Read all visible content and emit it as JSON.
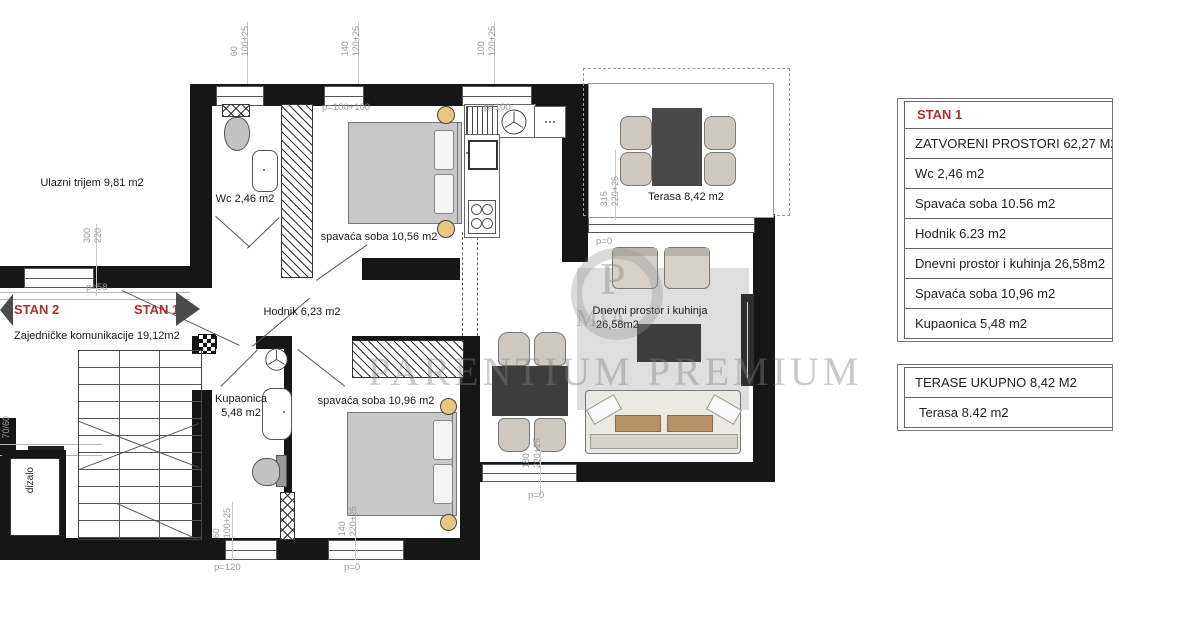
{
  "plan": {
    "labels": {
      "ulazni": "Ulazni trijem 9,81 m2",
      "wc": "Wc 2,46 m2",
      "soba1": "spavaća soba 10,56 m2",
      "terasa": "Terasa 8,42 m2",
      "hodnik": "Hodnik 6,23 m2",
      "zajednicke": "Zajedničke komunikacije 19,12m2",
      "kupaonica_1": "Kupaonica",
      "kupaonica_2": "5,48 m2",
      "soba2": "spavaća soba 10,96 m2",
      "dnevni_1": "Dnevni prostor i kuhinja",
      "dnevni_2": "26,58m2",
      "dizalo": "dizalo",
      "stan1": "STAN 1",
      "stan2": "STAN 2"
    },
    "dims": {
      "top1a": "60",
      "top1b": "100+25",
      "top2a": "140",
      "top2b": "120+25",
      "top3a": "100",
      "top3b": "120+25",
      "ter_a": "315",
      "ter_b": "220+25",
      "left_a": "300",
      "left_b": "220",
      "left_p": "p=58",
      "lift": "70/60",
      "bot1a": "60",
      "bot1b": "100+25",
      "bot1p": "p=120",
      "bot2a": "140",
      "bot2b": "220+25",
      "bot2p": "p=0",
      "liv_a": "180",
      "liv_b": "220+25",
      "liv_p": "p=0",
      "kit_p1": "p=100+100",
      "kit_p2": "p=100",
      "ter_p": "p=0"
    },
    "watermark": {
      "text": "PARENTIUM PREMIUM",
      "logo": "P",
      "logo_sub": "MIA"
    }
  },
  "tables": {
    "stan1": {
      "title": "STAN 1",
      "rows": [
        "ZATVORENI PROSTORI 62,27 M2",
        "Wc 2,46 m2",
        "Spavaća soba 10.56 m2",
        "Hodnik 6.23 m2",
        "Dnevni prostor i kuhinja 26,58m2",
        "Spavaća soba 10,96 m2",
        "Kupaonica 5,48 m2"
      ]
    },
    "terase": {
      "title": "TERASE UKUPNO 8,42 M2",
      "rows": [
        "Terasa 8.42 m2"
      ]
    }
  },
  "colors": {
    "wall": "#161616",
    "accent_red": "#b0302c",
    "dim_gray": "#9a9a9a",
    "furniture_gray": "#c8c8c8",
    "dark_furniture": "#3d3d3d",
    "tan": "#ba9166"
  }
}
